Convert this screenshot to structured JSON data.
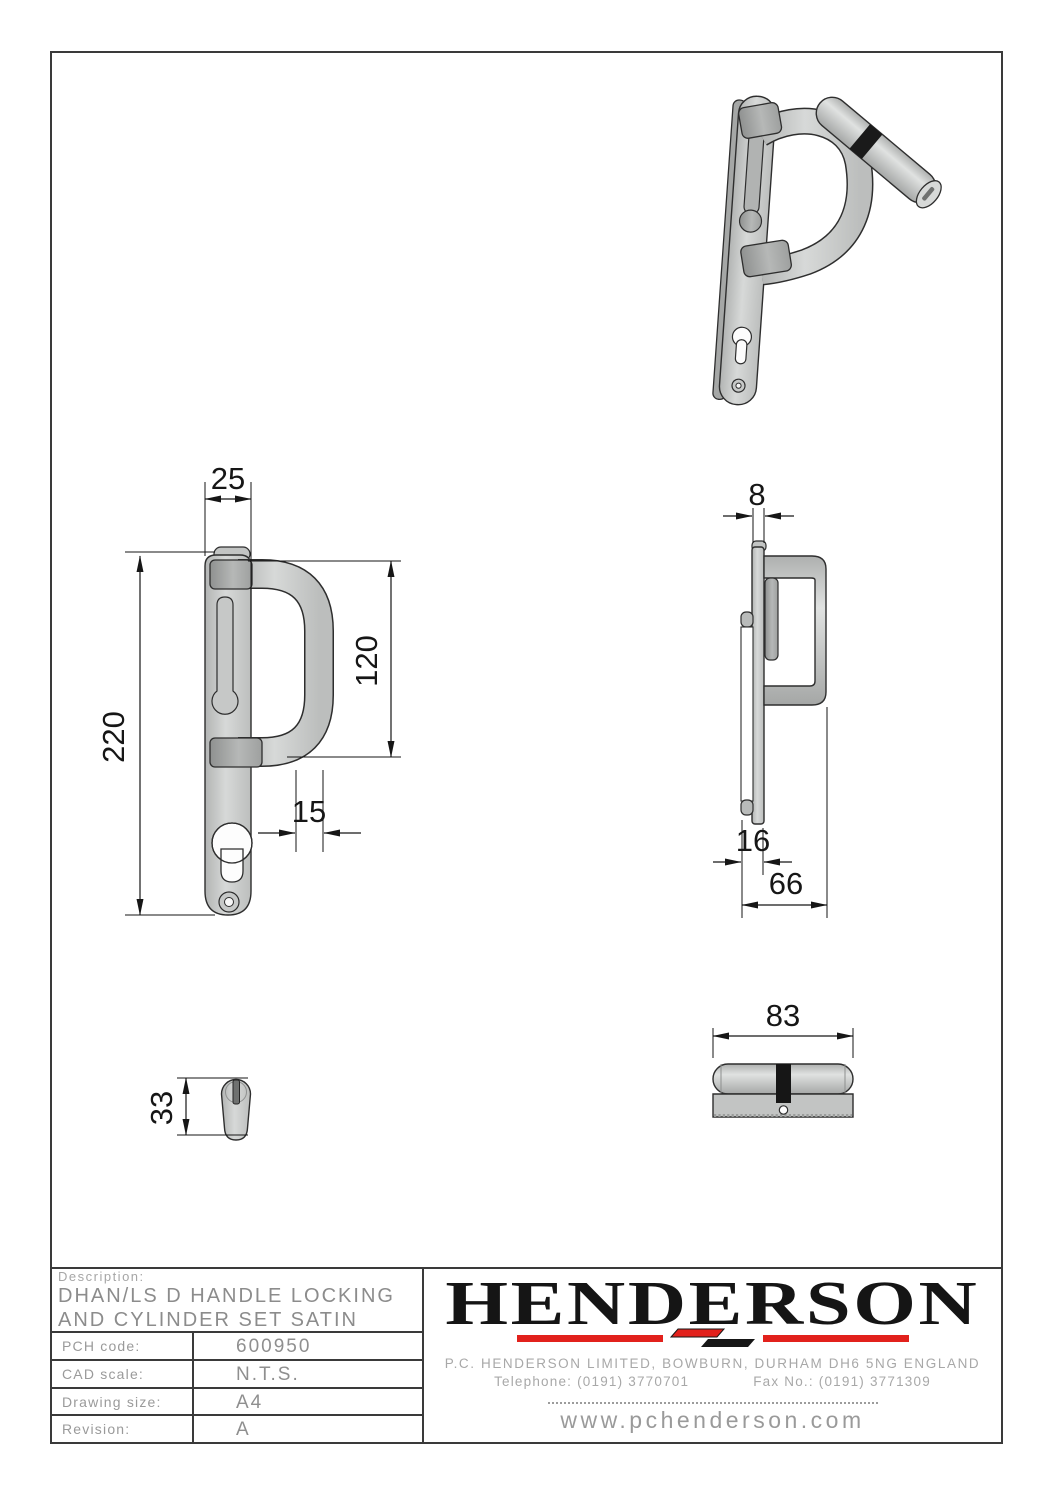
{
  "drawing": {
    "dimensions": {
      "plate_width": "25",
      "plate_height": "220",
      "handle_height": "120",
      "handle_section": "15",
      "plate_thickness": "8",
      "cylinder_projection": "16",
      "overall_depth": "66",
      "cylinder_height": "33",
      "cylinder_length": "83"
    }
  },
  "title_block": {
    "description_label": "Description:",
    "description_lines": [
      "DHAN/LS D HANDLE LOCKING",
      "AND CYLINDER SET SATIN"
    ],
    "fields": [
      {
        "label": "PCH code:",
        "value": "600950"
      },
      {
        "label": "CAD scale:",
        "value": "N.T.S."
      },
      {
        "label": "Drawing size:",
        "value": "A4"
      },
      {
        "label": "Revision:",
        "value": "A"
      }
    ],
    "brand": {
      "logo_text": "HENDERSON",
      "emblem_icon": "henderson-h-arrows",
      "accent_color": "#e2211c",
      "address": "P.C. HENDERSON LIMITED, BOWBURN, DURHAM DH6 5NG ENGLAND",
      "telephone": "Telephone: (0191) 3770701",
      "fax": "Fax No.: (0191) 3771309",
      "website": "www.pchenderson.com"
    }
  },
  "colors": {
    "metal_light": "#d7d9d8",
    "metal_mid": "#c2c4c3",
    "metal_dark": "#9ea09f",
    "outline": "#2e2e2e",
    "dimension_text": "#161616",
    "title_text": "#9a9a9a",
    "accent_red": "#e2211c"
  }
}
